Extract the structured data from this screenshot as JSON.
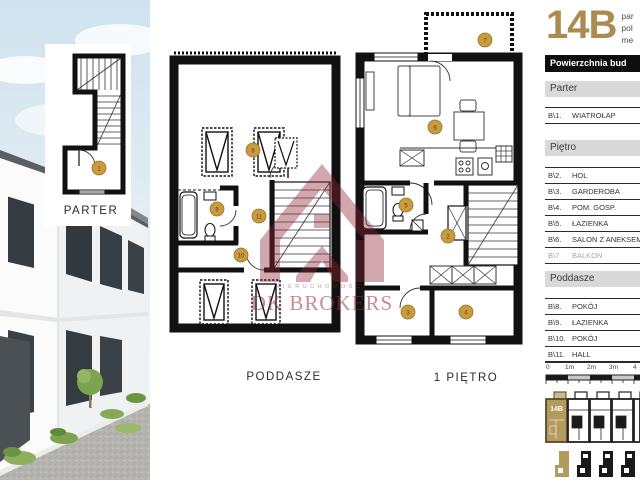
{
  "header": {
    "unit_number": "14B",
    "side_fragments": [
      "par",
      "pol",
      "me"
    ],
    "table_title": "Powierzchnia bud"
  },
  "legend": {
    "sections": [
      {
        "title": "Parter",
        "rows": [
          {
            "id": "B\\1.",
            "name": "WIATROŁAP"
          }
        ]
      },
      {
        "title": "Piętro",
        "rows": [
          {
            "id": "B\\2.",
            "name": "HOL"
          },
          {
            "id": "B\\3.",
            "name": "GARDEROBA"
          },
          {
            "id": "B\\4.",
            "name": "POM. GOSP."
          },
          {
            "id": "B\\5.",
            "name": "ŁAZIENKA"
          },
          {
            "id": "B\\6.",
            "name": "SALON Z ANEKSEM"
          },
          {
            "id": "B\\7",
            "name": "BALKON"
          }
        ]
      },
      {
        "title": "Poddasze",
        "rows": [
          {
            "id": "B\\8.",
            "name": "POKÓJ"
          },
          {
            "id": "B\\9.",
            "name": "ŁAZIENKA"
          },
          {
            "id": "B\\10.",
            "name": "POKÓJ"
          },
          {
            "id": "B\\11.",
            "name": "HALL"
          }
        ]
      }
    ]
  },
  "scalebar": {
    "labels": [
      "0",
      "1m",
      "2m",
      "3m",
      "4"
    ]
  },
  "site": {
    "unit_label": "14B"
  },
  "plans": {
    "parter": {
      "label": "PARTER",
      "marker": "1"
    },
    "poddasze": {
      "label": "PODDASZE",
      "markers": [
        "8",
        "9",
        "11",
        "10"
      ]
    },
    "pietro": {
      "label": "1 PIĘTRO",
      "markers": [
        "7",
        "6",
        "5",
        "2",
        "3",
        "4"
      ]
    }
  },
  "watermark": {
    "line1": "NIERUCHOMOŚCI",
    "line2": "DK BROKERS"
  },
  "colors": {
    "gold": "#ab8c50",
    "marker_gold": "#c99b3f",
    "watermark_red": "#8e2433"
  }
}
